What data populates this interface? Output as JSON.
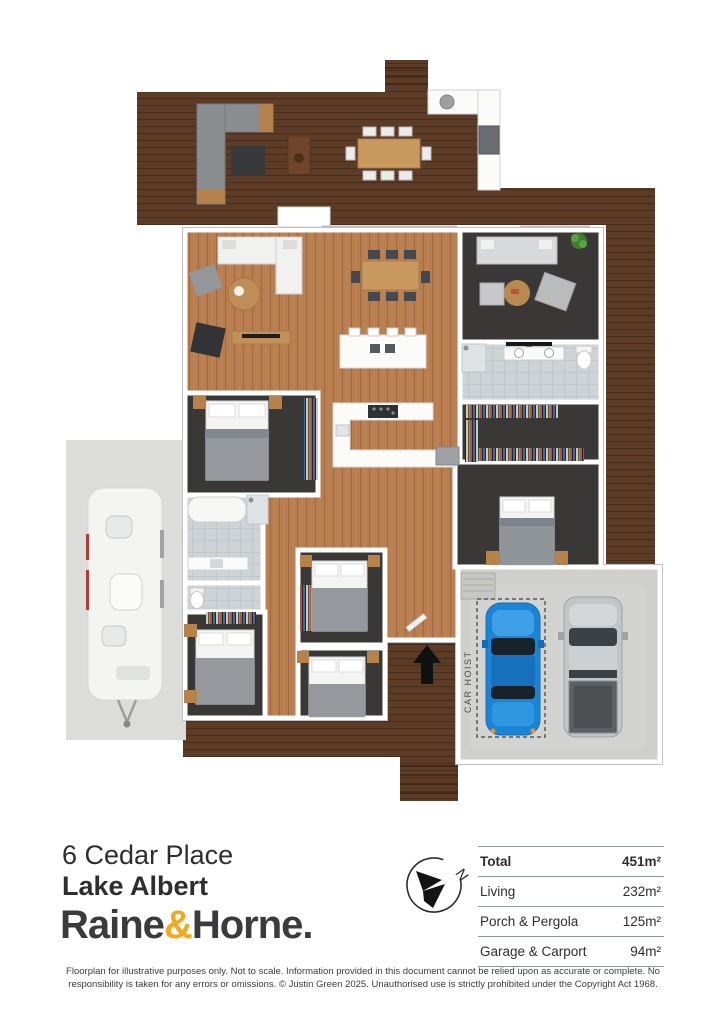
{
  "document": {
    "type": "floorplan-flyer"
  },
  "floorplan": {
    "car_hoist_label": "CAR HOIST",
    "colors": {
      "deck_wood": "#5c3b27",
      "interior_wood": "#b97e50",
      "carpet": "#3a3836",
      "tile": "#ced3d6",
      "concrete": "#cfd0cc",
      "wall": "#ffffff",
      "car_blue": "#1b84d6",
      "ute_gray": "#c3c6c8"
    }
  },
  "footer": {
    "address_line1": "6 Cedar Place",
    "address_line2": "Lake Albert",
    "logo": {
      "word1": "Raine",
      "ampersand": "&",
      "word2": "Horne.",
      "ampersand_color": "#F6A81C",
      "text_color": "#3b3b3d"
    },
    "compass": {
      "north_label": "N"
    },
    "areas": {
      "rows": [
        {
          "label": "Total",
          "value": "451m²"
        },
        {
          "label": "Living",
          "value": "232m²"
        },
        {
          "label": "Porch & Pergola",
          "value": "125m²"
        },
        {
          "label": "Garage & Carport",
          "value": "94m²"
        }
      ]
    },
    "disclaimer": "Floorplan for illustrative purposes only. Not to scale. Information provided in this document cannot be relied upon as accurate or complete. No responsibility is taken for any errors or omissions. © Justin Green 2025. Unauthorised use is strictly prohibited under the Copyright Act 1968."
  }
}
